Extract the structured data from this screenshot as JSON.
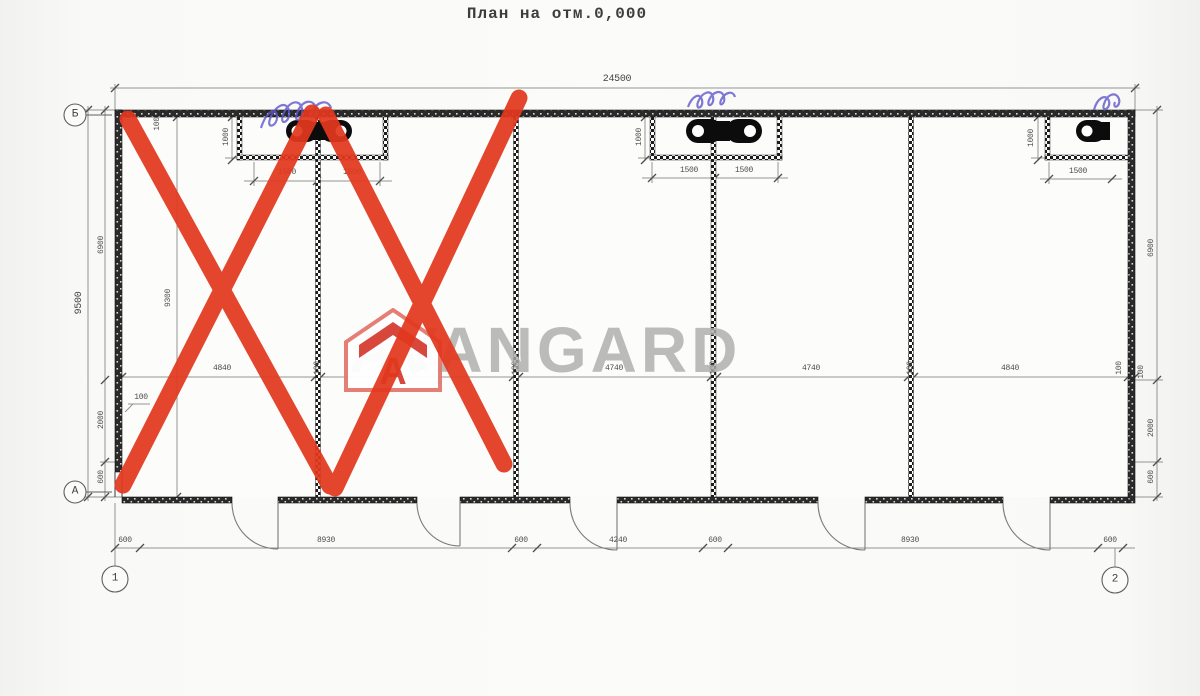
{
  "title": "План на отм.0,000",
  "watermark": {
    "brand": "AVANGARD",
    "logo_letter": "A",
    "logo_color": "#d8473c",
    "text_color": "#acacac"
  },
  "annotations": {
    "red_mark_color": "#e2391e",
    "pen_color": "#5f58cc"
  },
  "axes": {
    "row_top": "Б",
    "row_bottom": "А",
    "col_left": "1",
    "col_right": "2"
  },
  "dims": {
    "overall_width": "24500",
    "overall_height": "9500",
    "interior_height": "9300",
    "left_chain": [
      "6900",
      "2000",
      "600"
    ],
    "right_chain": [
      "6900",
      "2000",
      "600"
    ],
    "wall_notes": [
      "100",
      "100",
      "100"
    ],
    "mid_chain": [
      "4840",
      "100",
      "4740",
      "100",
      "4740",
      "100",
      "4740",
      "100",
      "4840",
      "100"
    ],
    "bottom_chain": [
      "600",
      "8930",
      "600",
      "4240",
      "600",
      "8930",
      "600"
    ],
    "niche_depth": "1000",
    "niche_left": [
      "1500",
      "1500"
    ],
    "niche_mid": [
      "1500",
      "1500"
    ],
    "niche_right": [
      "1500"
    ]
  }
}
